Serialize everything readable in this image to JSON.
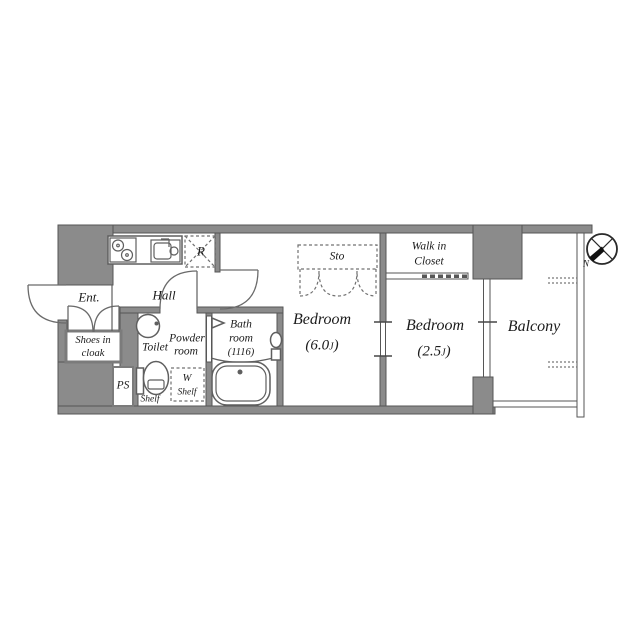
{
  "colors": {
    "wall": "#8b8b8b",
    "line": "#565656",
    "fixline": "#5f5f5f",
    "text": "#1b1b1b",
    "bg": "#ffffff"
  },
  "rooms": {
    "ent": "Ent.",
    "hall": "Hall",
    "shoes_line1": "Shoes in",
    "shoes_line2": "cloak",
    "ps": "PS",
    "toilet": "Toilet",
    "powder_line1": "Powder",
    "powder_line2": "room",
    "shelf": "Shelf",
    "w_shelf_line1": "W",
    "w_shelf_line2": "Shelf",
    "bath_line1": "Bath",
    "bath_line2": "room",
    "bath_line3": "(1116)",
    "bedroom1_label": "Bedroom",
    "bedroom1_size_open": "(6.0",
    "bedroom1_size_unit": "J",
    "bedroom1_size_close": ")",
    "sto": "Sto",
    "wic_line1": "Walk in",
    "wic_line2": "Closet",
    "bedroom2_label": "Bedroom",
    "bedroom2_size_open": "(2.5",
    "bedroom2_size_unit": "J",
    "bedroom2_size_close": ")",
    "balcony": "Balcony",
    "fridge": "R",
    "compass_north": "N"
  },
  "icons": {
    "compass": "compass-rose-icon",
    "stove": "stove-burners-icon",
    "sink": "kitchen-sink-icon",
    "refrigerator_space": "refrigerator-space-icon",
    "bathtub": "bathtub-icon",
    "toilet": "toilet-icon",
    "washbasin": "washbasin-icon",
    "entrance_door": "entrance-door-arc-icon",
    "shoe_cabinet_doors": "shoe-cabinet-doors-icon",
    "storage_bifold_doors": "storage-bifold-doors-icon"
  }
}
